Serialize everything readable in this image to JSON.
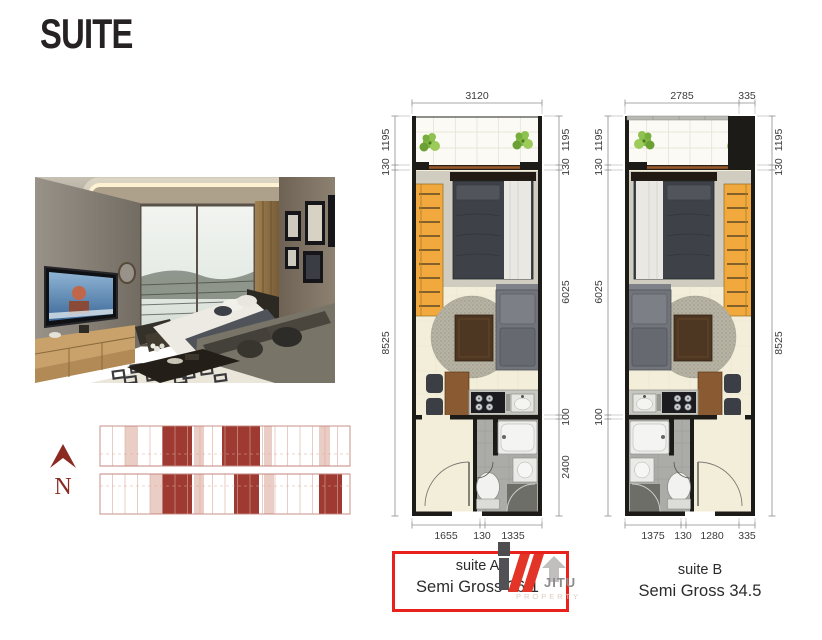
{
  "title": "SUITE",
  "plans": {
    "suiteA": {
      "name": "suite A",
      "area": "Semi Gross 36.1",
      "highlighted": true,
      "dims": {
        "top": [
          "3120"
        ],
        "left": [
          "1195",
          "130",
          "8525"
        ],
        "right": [
          "1195",
          "130",
          "6025",
          "100",
          "2400"
        ],
        "bottom": [
          "1655",
          "130",
          "1335"
        ]
      }
    },
    "suiteB": {
      "name": "suite B",
      "area": "Semi Gross 34.5",
      "highlighted": false,
      "dims": {
        "top": [
          "2785",
          "335"
        ],
        "left": [
          "1195",
          "130",
          "6025",
          "100"
        ],
        "right": [
          "1195",
          "130",
          "8525"
        ],
        "bottom": [
          "1375",
          "130",
          "1280",
          "335"
        ]
      }
    }
  },
  "keyplan": {
    "north_label": "N"
  },
  "watermark": {
    "brand": "JITU",
    "tagline": "PROPERTY"
  },
  "colors": {
    "highlight_box": "#e8211d",
    "logo_red": "#e23528",
    "keyplan_accent": "#8a2a20",
    "keyplan_unit_dark": "#9e3a32",
    "keyplan_unit_light": "#eacdc5",
    "wall_black": "#1d1b18",
    "floor_cream": "#f3eeda",
    "wardrobe_yellow": "#f1a93d"
  },
  "icons": {
    "north_arrow": "^",
    "plant": "*",
    "logo_mark": "///"
  }
}
